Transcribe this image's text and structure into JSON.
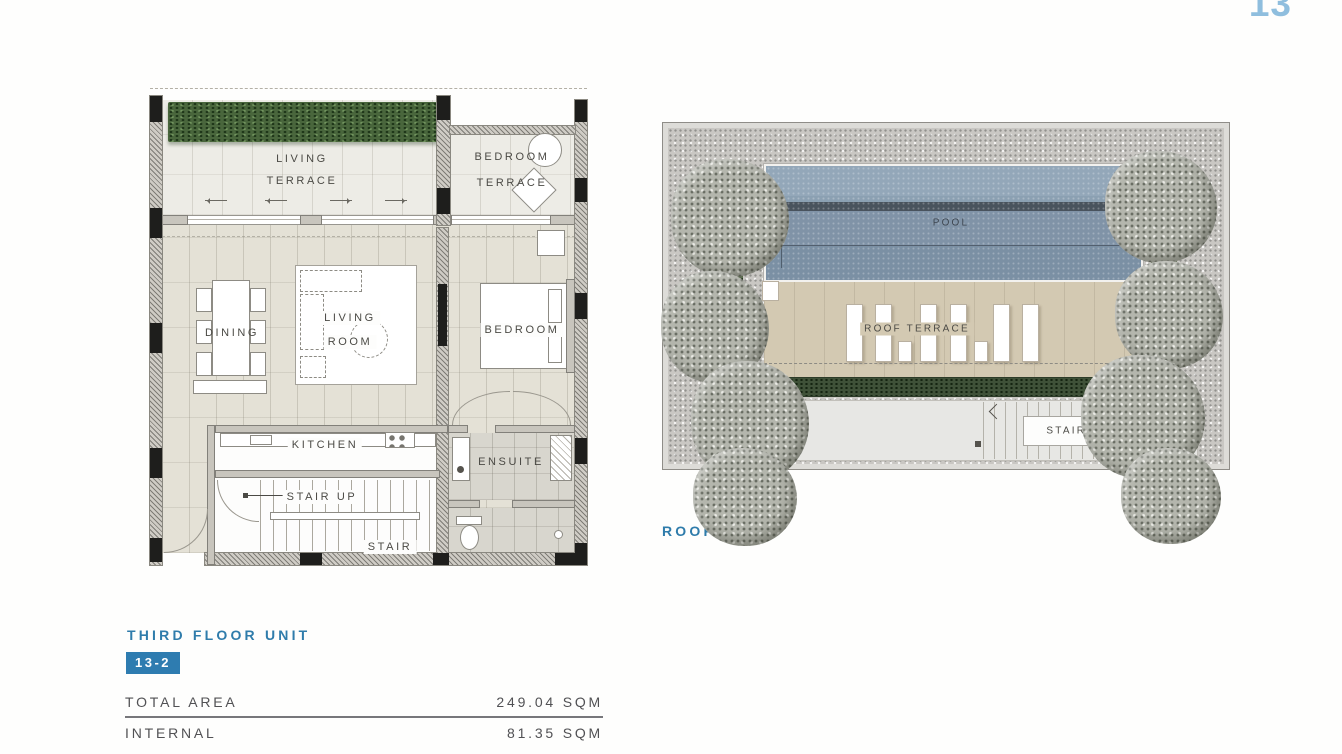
{
  "page": {
    "number": "13"
  },
  "colors": {
    "accent_blue": "#2f7cab",
    "page_number_blue": "#8fbede",
    "plan_label_gray": "#4b4a45",
    "pool_blue": "#7b90a4",
    "roof_terrace_beige": "#d3c9b2",
    "hedge_green": "#49663c"
  },
  "floor_plan": {
    "title": "THIRD FLOOR UNIT",
    "unit_badge": "13-2",
    "labels": {
      "living_terrace_line1": "LIVING",
      "living_terrace_line2": "TERRACE",
      "bedroom_terrace_line1": "BEDROOM",
      "bedroom_terrace_line2": "TERRACE",
      "dining": "DINING",
      "living_room_line1": "LIVING",
      "living_room_line2": "ROOM",
      "bedroom": "BEDROOM",
      "kitchen": "KITCHEN",
      "ensuite": "ENSUITE",
      "stair_up": "STAIR UP",
      "stair": "STAIR"
    }
  },
  "roof_plan": {
    "title": "ROOF PLAN",
    "labels": {
      "pool": "POOL",
      "roof_terrace": "ROOF TERRACE",
      "stair_down": "STAIR DOWN"
    }
  },
  "area_table": {
    "rows": [
      {
        "label": "TOTAL AREA",
        "value": "249.04 SQM"
      },
      {
        "label": "INTERNAL",
        "value": "81.35 SQM"
      }
    ]
  }
}
